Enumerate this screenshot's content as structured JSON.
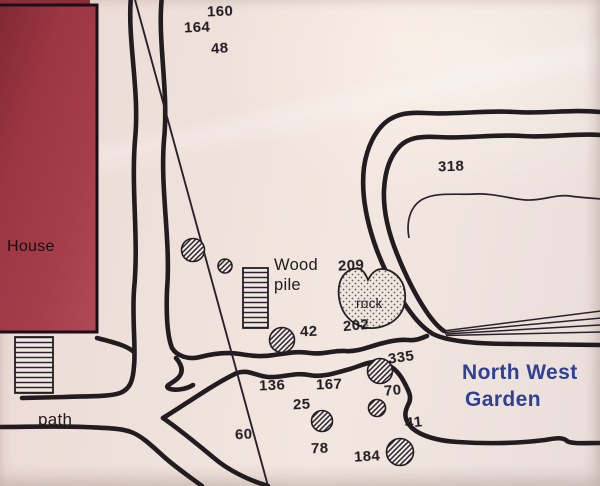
{
  "map": {
    "region_name_line1": "North West",
    "region_name_line2": "Garden",
    "labels": {
      "house": "House",
      "path": "path",
      "wood_pile_line1": "Wood",
      "wood_pile_line2": "pile",
      "rock": "rock"
    },
    "measurements": [
      {
        "value": "160",
        "x": 207,
        "y": 3,
        "tilt": -2
      },
      {
        "value": "164",
        "x": 184,
        "y": 19,
        "tilt": -2
      },
      {
        "value": "48",
        "x": 211,
        "y": 40,
        "tilt": -4
      },
      {
        "value": "318",
        "x": 438,
        "y": 158,
        "tilt": -2
      },
      {
        "value": "209",
        "x": 338,
        "y": 257,
        "tilt": -3
      },
      {
        "value": "202",
        "x": 343,
        "y": 317,
        "tilt": -5
      },
      {
        "value": "42",
        "x": 300,
        "y": 323,
        "tilt": -2
      },
      {
        "value": "335",
        "x": 388,
        "y": 349,
        "tilt": -8
      },
      {
        "value": "136",
        "x": 259,
        "y": 377,
        "tilt": -2
      },
      {
        "value": "167",
        "x": 316,
        "y": 376,
        "tilt": -2
      },
      {
        "value": "70",
        "x": 384,
        "y": 382,
        "tilt": -5
      },
      {
        "value": "25",
        "x": 293,
        "y": 396,
        "tilt": -2
      },
      {
        "value": "41",
        "x": 405,
        "y": 414,
        "tilt": -5
      },
      {
        "value": "60",
        "x": 235,
        "y": 426,
        "tilt": -3
      },
      {
        "value": "78",
        "x": 311,
        "y": 440,
        "tilt": -2
      },
      {
        "value": "184",
        "x": 354,
        "y": 448,
        "tilt": -3
      }
    ],
    "colors": {
      "house_fill": "#a03844",
      "region_text": "#2f4095",
      "line_ink": "#221c21",
      "paper": "#eee2dc"
    }
  }
}
